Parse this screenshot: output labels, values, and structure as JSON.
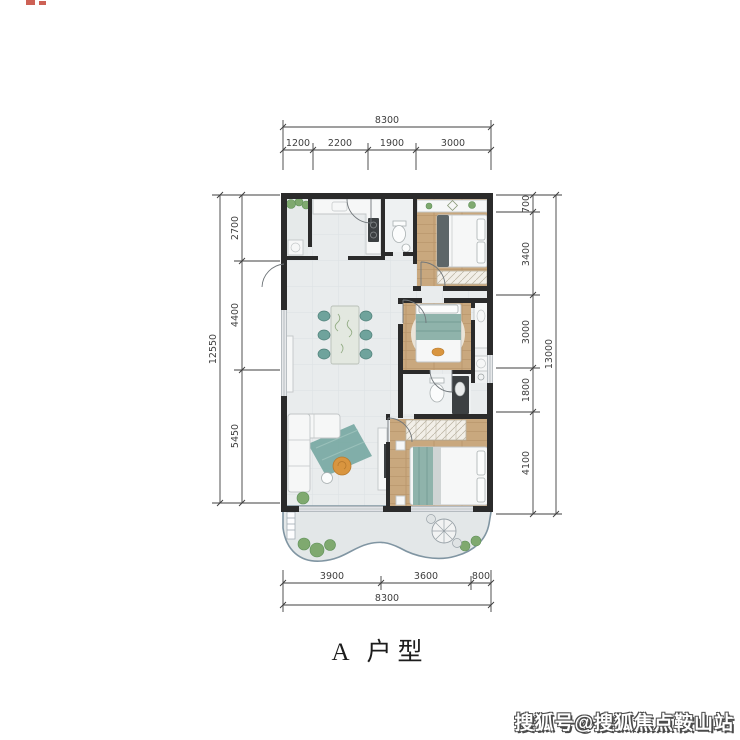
{
  "title": "A 户型",
  "watermark": "搜狐号@搜狐焦点鞍山站",
  "dims": {
    "top": {
      "total": "8300",
      "segments": [
        "1200",
        "2200",
        "1900",
        "3000"
      ]
    },
    "left": {
      "total": "12550",
      "segments": [
        "2700",
        "4400",
        "5450"
      ]
    },
    "right": {
      "total": "13000",
      "segments": [
        "700",
        "3400",
        "3000",
        "1800",
        "4100"
      ]
    },
    "bottom": {
      "total": "8300",
      "segments": [
        "3900",
        "3600",
        "800"
      ]
    }
  },
  "colors": {
    "wall": "#2b2b2b",
    "tile": "#e9eced",
    "wood": "#c9a87e",
    "teal": "#6fa39c",
    "teal_light": "#8fb3ab",
    "balcony": "#e3e7e8",
    "rail": "#8095a2",
    "furniture": "#f6f7f7",
    "furniture_line": "#c2c6c7",
    "accent_orange": "#d9953f",
    "plant": "#7fa96f",
    "dim": "#3f3f3f",
    "watermark_text": "#ffffff",
    "watermark_shadow": "#4a4a4a"
  }
}
